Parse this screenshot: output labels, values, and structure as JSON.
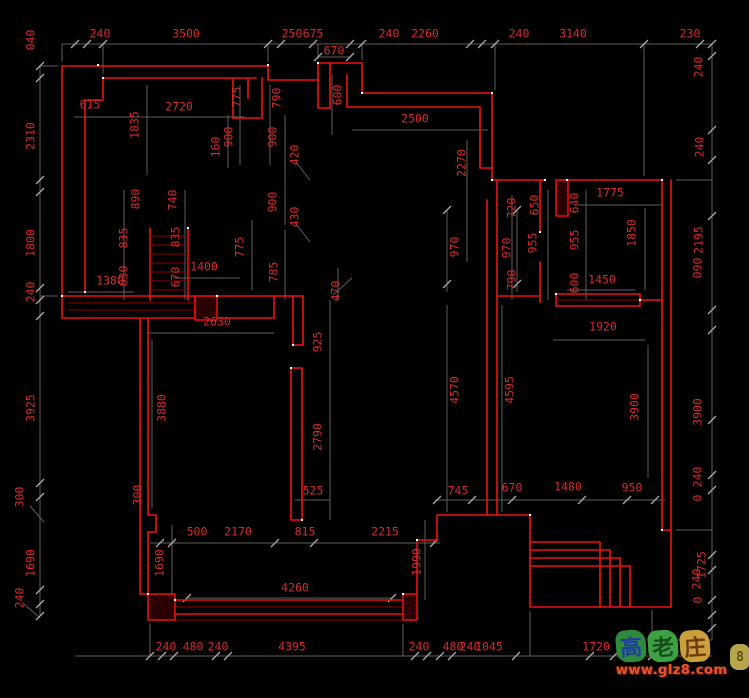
{
  "title": "CAD floor plan drawing with dimension annotations",
  "colors": {
    "background": "#000000",
    "wall": "#ee1111",
    "wall_dark": "#8f0000",
    "dim_line": "#5e5e5e",
    "dim_tick": "#a9a9a9",
    "dim_text": "#d92b2b",
    "snap_dot": "#ffffff",
    "watermark_url_color": "#e8542a"
  },
  "dimensions": [
    {
      "t": "240",
      "x": 100,
      "y": 34,
      "r": 0
    },
    {
      "t": "3500",
      "x": 186,
      "y": 34,
      "r": 0
    },
    {
      "t": "250",
      "x": 292,
      "y": 34,
      "r": 0
    },
    {
      "t": "675",
      "x": 313,
      "y": 34,
      "r": 0
    },
    {
      "t": "670",
      "x": 334,
      "y": 51,
      "r": 0
    },
    {
      "t": "240",
      "x": 389,
      "y": 34,
      "r": 0
    },
    {
      "t": "2260",
      "x": 425,
      "y": 34,
      "r": 0
    },
    {
      "t": "240",
      "x": 519,
      "y": 34,
      "r": 0
    },
    {
      "t": "3140",
      "x": 573,
      "y": 34,
      "r": 0
    },
    {
      "t": "230",
      "x": 690,
      "y": 34,
      "r": 0
    },
    {
      "t": "040",
      "x": 31,
      "y": 40,
      "r": 1
    },
    {
      "t": "2310",
      "x": 31,
      "y": 136,
      "r": 1
    },
    {
      "t": "1800",
      "x": 31,
      "y": 243,
      "r": 1
    },
    {
      "t": "240",
      "x": 31,
      "y": 292,
      "r": 1
    },
    {
      "t": "3925",
      "x": 31,
      "y": 408,
      "r": 1
    },
    {
      "t": "300",
      "x": 20,
      "y": 497,
      "r": 1
    },
    {
      "t": "1690",
      "x": 31,
      "y": 563,
      "r": 1
    },
    {
      "t": "240",
      "x": 20,
      "y": 598,
      "r": 1
    },
    {
      "t": "240",
      "x": 699,
      "y": 67,
      "r": 1
    },
    {
      "t": "240",
      "x": 700,
      "y": 147,
      "r": 1
    },
    {
      "t": "2195",
      "x": 699,
      "y": 240,
      "r": 1
    },
    {
      "t": "090",
      "x": 698,
      "y": 268,
      "r": 1
    },
    {
      "t": "3900",
      "x": 698,
      "y": 412,
      "r": 1
    },
    {
      "t": "240",
      "x": 698,
      "y": 477,
      "r": 1
    },
    {
      "t": "0",
      "x": 698,
      "y": 498,
      "r": 1
    },
    {
      "t": "1725",
      "x": 702,
      "y": 565,
      "r": 1
    },
    {
      "t": "240",
      "x": 697,
      "y": 579,
      "r": 1
    },
    {
      "t": "0",
      "x": 698,
      "y": 600,
      "r": 1
    },
    {
      "t": "615",
      "x": 90,
      "y": 105,
      "r": 0
    },
    {
      "t": "2720",
      "x": 179,
      "y": 107,
      "r": 0
    },
    {
      "t": "1835",
      "x": 135,
      "y": 125,
      "r": 1
    },
    {
      "t": "775",
      "x": 237,
      "y": 97,
      "r": 1
    },
    {
      "t": "790",
      "x": 277,
      "y": 98,
      "r": 1
    },
    {
      "t": "160",
      "x": 216,
      "y": 147,
      "r": 1
    },
    {
      "t": "900",
      "x": 229,
      "y": 137,
      "r": 1
    },
    {
      "t": "900",
      "x": 273,
      "y": 137,
      "r": 1
    },
    {
      "t": "420",
      "x": 295,
      "y": 155,
      "r": 1
    },
    {
      "t": "900",
      "x": 273,
      "y": 202,
      "r": 1
    },
    {
      "t": "430",
      "x": 295,
      "y": 217,
      "r": 1
    },
    {
      "t": "890",
      "x": 136,
      "y": 199,
      "r": 1
    },
    {
      "t": "740",
      "x": 173,
      "y": 200,
      "r": 1
    },
    {
      "t": "835",
      "x": 124,
      "y": 238,
      "r": 1
    },
    {
      "t": "835",
      "x": 176,
      "y": 237,
      "r": 1
    },
    {
      "t": "630",
      "x": 124,
      "y": 276,
      "r": 1
    },
    {
      "t": "670",
      "x": 176,
      "y": 277,
      "r": 1
    },
    {
      "t": "775",
      "x": 240,
      "y": 247,
      "r": 1
    },
    {
      "t": "785",
      "x": 274,
      "y": 272,
      "r": 1
    },
    {
      "t": "1400",
      "x": 204,
      "y": 267,
      "r": 0
    },
    {
      "t": "1380",
      "x": 110,
      "y": 281,
      "r": 0
    },
    {
      "t": "2630",
      "x": 217,
      "y": 322,
      "r": 0
    },
    {
      "t": "600",
      "x": 338,
      "y": 95,
      "r": 1
    },
    {
      "t": "2500",
      "x": 415,
      "y": 119,
      "r": 0
    },
    {
      "t": "2270",
      "x": 462,
      "y": 163,
      "r": 1
    },
    {
      "t": "970",
      "x": 455,
      "y": 247,
      "r": 1
    },
    {
      "t": "970",
      "x": 507,
      "y": 248,
      "r": 1
    },
    {
      "t": "720",
      "x": 512,
      "y": 208,
      "r": 1
    },
    {
      "t": "650",
      "x": 535,
      "y": 205,
      "r": 1
    },
    {
      "t": "955",
      "x": 533,
      "y": 243,
      "r": 1
    },
    {
      "t": "640",
      "x": 575,
      "y": 203,
      "r": 1
    },
    {
      "t": "955",
      "x": 575,
      "y": 240,
      "r": 1
    },
    {
      "t": "1775",
      "x": 610,
      "y": 193,
      "r": 0
    },
    {
      "t": "1850",
      "x": 632,
      "y": 233,
      "r": 1
    },
    {
      "t": "790",
      "x": 512,
      "y": 280,
      "r": 1
    },
    {
      "t": "600",
      "x": 575,
      "y": 283,
      "r": 1
    },
    {
      "t": "1450",
      "x": 602,
      "y": 280,
      "r": 0
    },
    {
      "t": "1920",
      "x": 603,
      "y": 327,
      "r": 0
    },
    {
      "t": "470",
      "x": 336,
      "y": 291,
      "r": 1
    },
    {
      "t": "925",
      "x": 318,
      "y": 342,
      "r": 1
    },
    {
      "t": "2790",
      "x": 318,
      "y": 437,
      "r": 1
    },
    {
      "t": "3880",
      "x": 162,
      "y": 408,
      "r": 1
    },
    {
      "t": "300",
      "x": 138,
      "y": 495,
      "r": 1
    },
    {
      "t": "4570",
      "x": 455,
      "y": 390,
      "r": 1
    },
    {
      "t": "4595",
      "x": 510,
      "y": 390,
      "r": 1
    },
    {
      "t": "3900",
      "x": 635,
      "y": 407,
      "r": 1
    },
    {
      "t": "525",
      "x": 313,
      "y": 491,
      "r": 0
    },
    {
      "t": "745",
      "x": 458,
      "y": 491,
      "r": 0
    },
    {
      "t": "670",
      "x": 512,
      "y": 488,
      "r": 0
    },
    {
      "t": "1480",
      "x": 568,
      "y": 487,
      "r": 0
    },
    {
      "t": "950",
      "x": 632,
      "y": 488,
      "r": 0
    },
    {
      "t": "500",
      "x": 197,
      "y": 532,
      "r": 0
    },
    {
      "t": "2170",
      "x": 238,
      "y": 532,
      "r": 0
    },
    {
      "t": "815",
      "x": 305,
      "y": 532,
      "r": 0
    },
    {
      "t": "2215",
      "x": 385,
      "y": 532,
      "r": 0
    },
    {
      "t": "1690",
      "x": 160,
      "y": 563,
      "r": 1
    },
    {
      "t": "1990",
      "x": 417,
      "y": 562,
      "r": 1
    },
    {
      "t": "4260",
      "x": 295,
      "y": 588,
      "r": 0
    },
    {
      "t": "240",
      "x": 166,
      "y": 647,
      "r": 0
    },
    {
      "t": "480",
      "x": 193,
      "y": 647,
      "r": 0
    },
    {
      "t": "240",
      "x": 218,
      "y": 647,
      "r": 0
    },
    {
      "t": "4395",
      "x": 292,
      "y": 647,
      "r": 0
    },
    {
      "t": "240",
      "x": 419,
      "y": 647,
      "r": 0
    },
    {
      "t": "480",
      "x": 453,
      "y": 647,
      "r": 0
    },
    {
      "t": "240",
      "x": 470,
      "y": 647,
      "r": 0
    },
    {
      "t": "1045",
      "x": 489,
      "y": 647,
      "r": 0
    },
    {
      "t": "1720",
      "x": 596,
      "y": 647,
      "r": 0
    },
    {
      "t": "710",
      "x": 662,
      "y": 647,
      "r": 0
    }
  ],
  "watermark": {
    "chars": [
      {
        "ch": "高",
        "blob": "#2e8b3a",
        "ink": "#1f3f9e"
      },
      {
        "ch": "老",
        "blob": "#3da043",
        "ink": "#174d1b"
      },
      {
        "ch": "庄",
        "blob": "#c9a03b",
        "ink": "#6e3a12"
      }
    ],
    "url": "www.glz8.com",
    "emoticon": "8"
  }
}
